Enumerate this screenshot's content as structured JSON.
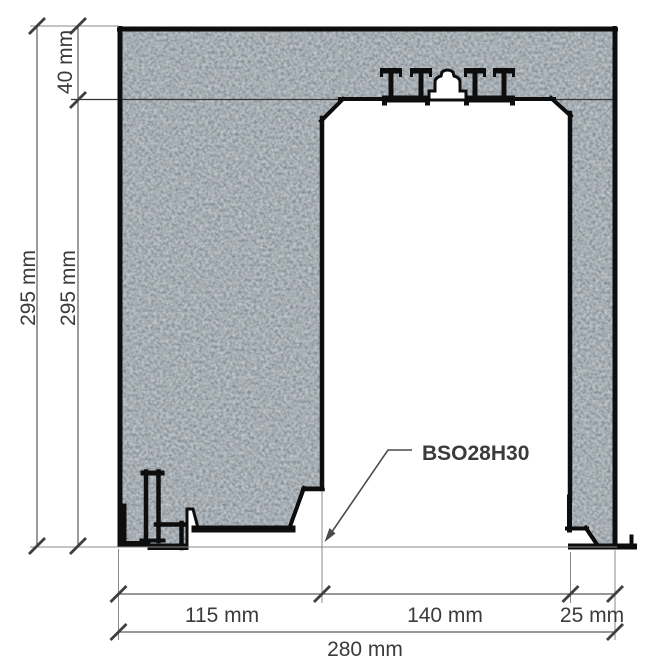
{
  "diagram": {
    "product_label": "BSO28H30",
    "dimensions": {
      "offset_top": "40 mm",
      "height_left_outer": "295 mm",
      "height_left_inner": "295 mm",
      "width_left_segment": "115 mm",
      "width_opening": "140 mm",
      "width_right_segment": "25 mm",
      "width_total": "280 mm"
    },
    "colors": {
      "background": "#ffffff",
      "wall_fill": "#616b73",
      "outline": "#0d0d0d",
      "dimension_line": "#5a5a5a",
      "extension_line": "#8a8a8a",
      "tick": "#3f3f3f",
      "label_text": "#3b3b3b"
    }
  }
}
